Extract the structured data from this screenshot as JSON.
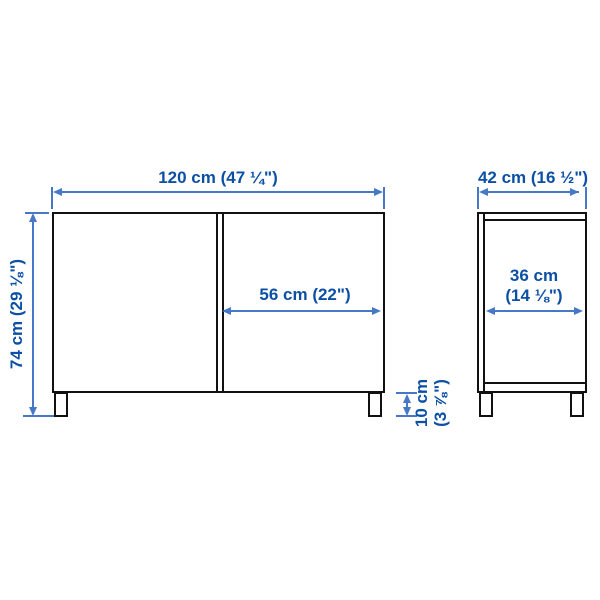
{
  "diagram_title": "cabinet-dimension-diagram",
  "colors": {
    "dimension_text": "#0c50a5",
    "dimension_line": "#4678c8",
    "outline": "#111111",
    "background": "#ffffff"
  },
  "front_view": {
    "width_label": "120 cm (47 ¼\")",
    "height_label": "74 cm (29 ⅛\")",
    "door_width_label": "56 cm (22\")",
    "leg_height_label_line1": "10 cm",
    "leg_height_label_line2": "(3 ⅞\")"
  },
  "side_view": {
    "depth_label": "42 cm (16 ½\")",
    "inner_depth_label_line1": "36 cm",
    "inner_depth_label_line2": "(14 ⅛\")"
  }
}
